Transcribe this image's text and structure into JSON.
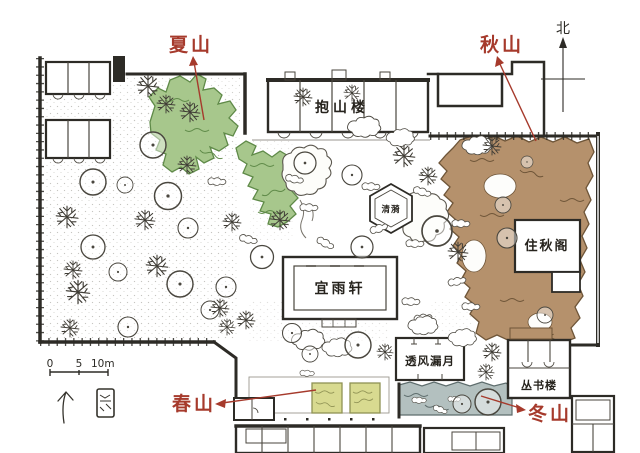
{
  "plan": {
    "annotations": {
      "summer": "夏山",
      "autumn": "秋山",
      "spring": "春山",
      "winter": "冬山"
    },
    "buildings": {
      "baoshanlou": "抱山楼",
      "qingyi": "清漪",
      "zhuqiuge": "住秋阁",
      "yiyuxuan": "宜雨轩",
      "toufenglouyue": "透风漏月",
      "congshulou": "丛书楼"
    },
    "compass": {
      "north": "北"
    },
    "scale_bar": {
      "tick0": "0",
      "tick1": "5",
      "tick2": "10m"
    }
  },
  "colors": {
    "annotation_red": "#a63a2c",
    "ink": "#2d2b26",
    "summer_green": "#a7c78c",
    "summer_green_edge": "#5f8a48",
    "autumn_brown": "#b5916c",
    "autumn_brown_edge": "#6e5538",
    "spring_yellow": "#d8da90",
    "spring_yellow_edge": "#8f9254",
    "winter_gray": "#b3c0bf",
    "winter_gray_edge": "#5d6c6c",
    "paper": "#fdfdfb"
  }
}
